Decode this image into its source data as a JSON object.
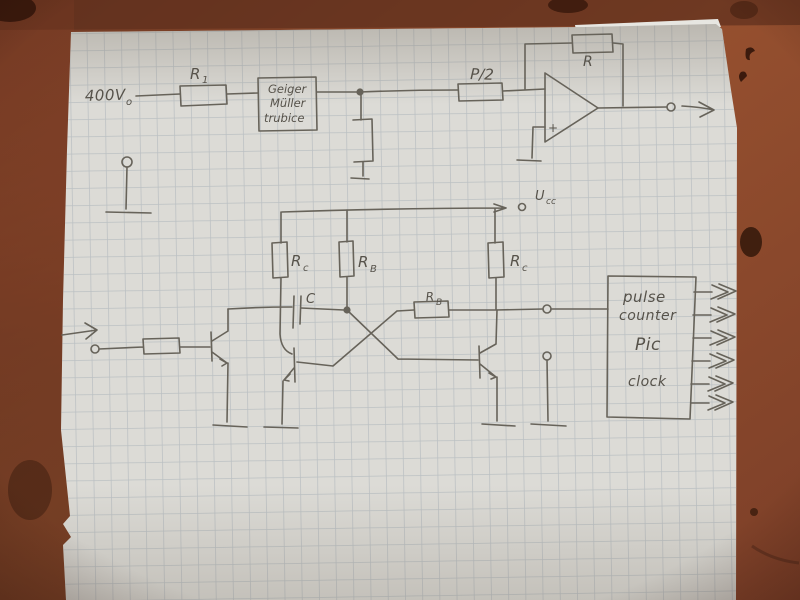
{
  "labels": {
    "supply": {
      "base": "400V",
      "sub": "o"
    },
    "r1": {
      "base": "R",
      "sub": "1"
    },
    "p_half": "P/2",
    "feedback_r": "R",
    "opamp_plus": "+",
    "ucc": {
      "base": "U",
      "sub": "cc"
    },
    "rc_left": {
      "base": "R",
      "sub": "c"
    },
    "rb_mid": {
      "base": "R",
      "sub": "B"
    },
    "rc_right": {
      "base": "R",
      "sub": "c"
    },
    "cap": "C",
    "rb_cross": {
      "base": "R",
      "sub": "B"
    }
  },
  "gm_box": {
    "lines": [
      "Geiger",
      "Müller",
      "trubice"
    ]
  },
  "pulse_box": {
    "lines": [
      "pulse",
      "counter",
      "Pic",
      "clock"
    ]
  },
  "colors": {
    "table": "#8e4a2f",
    "table_dark": "#5e301d",
    "paper": "#dcdbd6",
    "paper_under": "#e7e6e1",
    "grid": "#9aa5b0",
    "pencil": "#67635a",
    "ink_text": "#56524a"
  }
}
